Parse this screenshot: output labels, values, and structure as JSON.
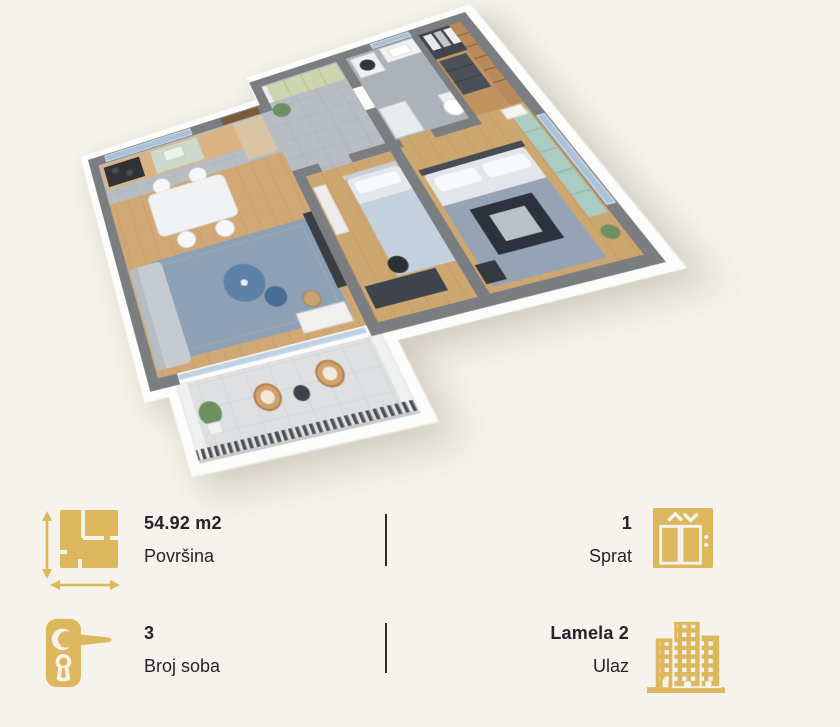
{
  "page": {
    "background": "#f6f3ec"
  },
  "palette": {
    "gold": "#ddb75e",
    "text": "#26242b",
    "divider": "#141414",
    "wall_gray": "#7b7e81",
    "wood_floor": "#d1a874",
    "tile_floor": "#b7bdc3",
    "rug_blue": "#8ea0b4",
    "window_glass": "#a9c2da"
  },
  "floorplan": {
    "name": "apartment-3d-floorplan",
    "description": "isometric render of a two-bedroom apartment with kitchen, living-dining room, hallway, bathroom, wardrobe, two bedrooms and a balcony"
  },
  "info": {
    "items": [
      {
        "id": "area",
        "icon": "floorplan-dimensions-icon",
        "value": "54.92 m2",
        "label": "Površina"
      },
      {
        "id": "floor",
        "icon": "elevator-icon",
        "value": "1",
        "label": "Sprat"
      },
      {
        "id": "rooms",
        "icon": "door-handle-icon",
        "value": "3",
        "label": "Broj soba"
      },
      {
        "id": "entrance",
        "icon": "building-icon",
        "value": "Lamela 2",
        "label": "Ulaz"
      }
    ]
  }
}
